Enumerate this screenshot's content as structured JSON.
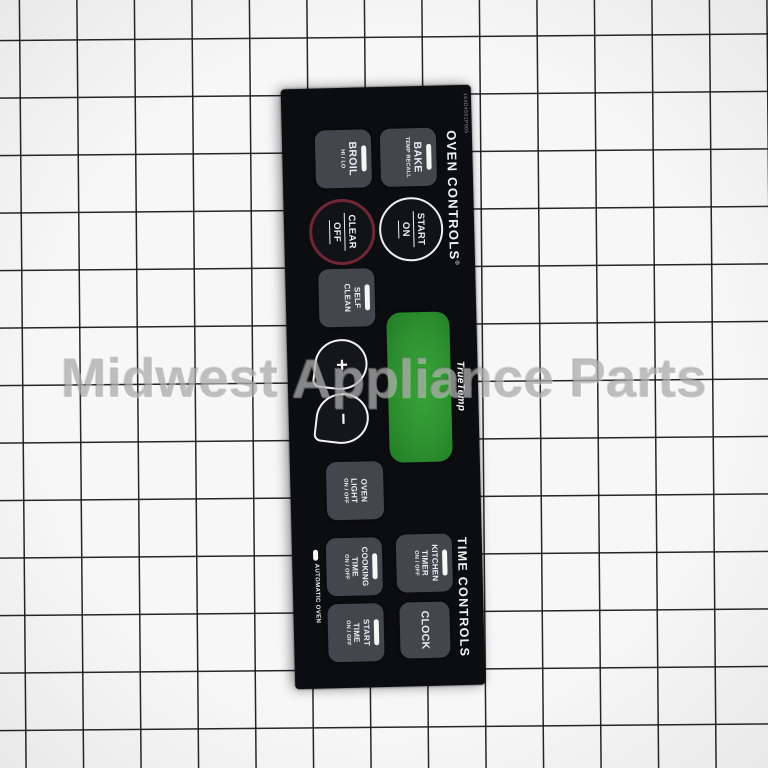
{
  "watermark": {
    "text": "Midwest Appliance Parts"
  },
  "panel": {
    "part_number": "164D4501P005",
    "oven": {
      "heading": "OVEN CONTROLS",
      "reg": "®",
      "bake": {
        "label": "BAKE",
        "sub": "TEMP RECALL"
      },
      "broil": {
        "label": "BROIL",
        "sub": "HI / LO"
      },
      "start_on": {
        "line1": "START",
        "line2": "ON"
      },
      "clear_off": {
        "line1": "CLEAR",
        "line2": "OFF"
      },
      "self_clean": {
        "line1": "SELF",
        "line2": "CLEAN"
      },
      "plus": "+",
      "minus": "−",
      "oven_light": {
        "line1": "OVEN",
        "line2": "LIGHT",
        "sub": "ON / OFF"
      }
    },
    "display": {
      "brand": "TrueTemp"
    },
    "time": {
      "heading": "TIME CONTROLS",
      "kitchen_timer": {
        "line1": "KITCHEN",
        "line2": "TIMER",
        "sub": "ON / OFF"
      },
      "cooking_time": {
        "line1": "COOKING",
        "line2": "TIME",
        "sub": "ON / OFF"
      },
      "clock": {
        "label": "CLOCK"
      },
      "start_time": {
        "line1": "START",
        "line2": "TIME",
        "sub": "ON / OFF"
      },
      "automatic_oven": "AUTOMATIC OVEN"
    },
    "colors": {
      "panel_bg": "#0c0d10",
      "button_bg": "#43464d",
      "display_green": "#2e9130",
      "clear_ring": "#702634",
      "start_ring": "#eef0f2",
      "grid_paper": "#f7f7f8"
    }
  }
}
